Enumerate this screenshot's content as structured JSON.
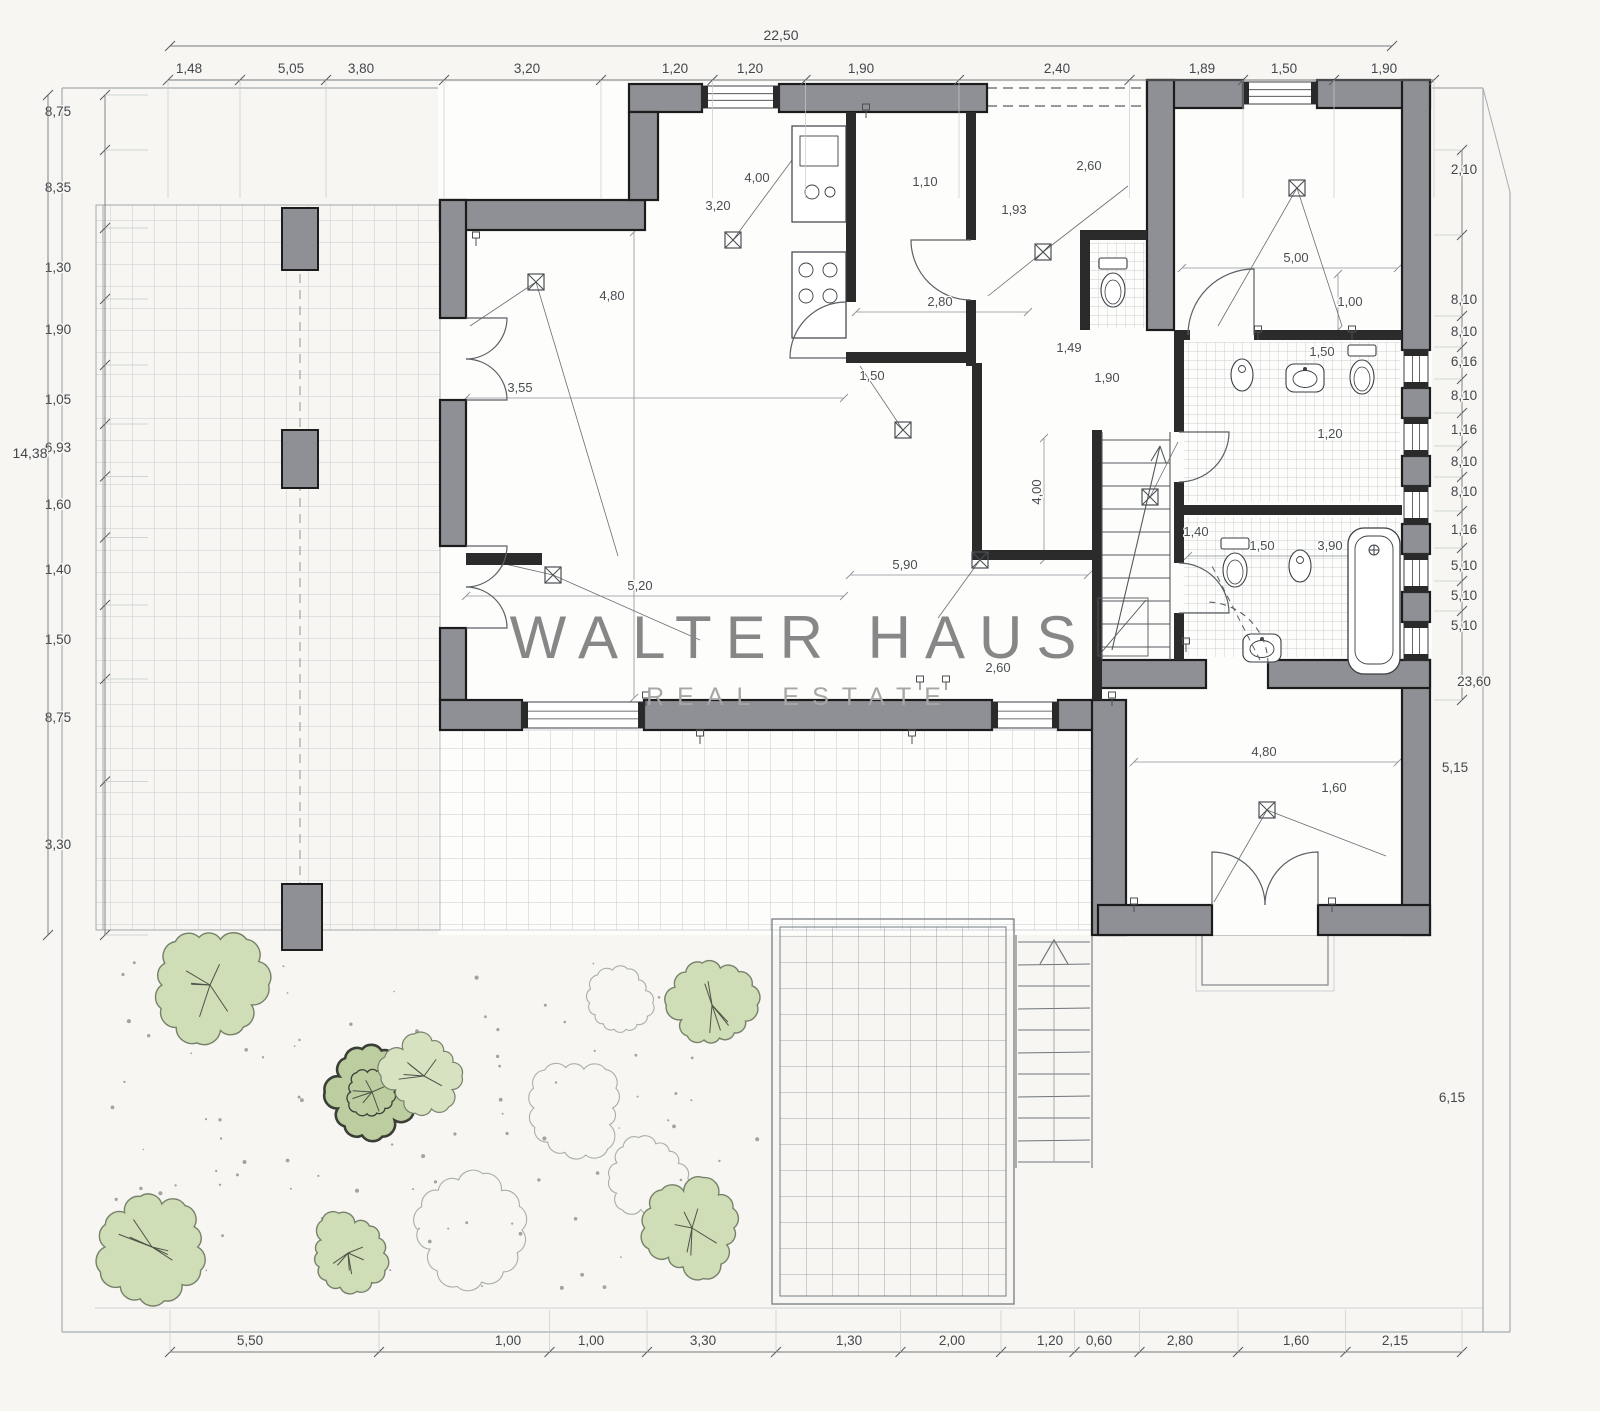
{
  "watermark": {
    "title": "WALTER HAUS",
    "subtitle": "REAL ESTATE"
  },
  "colors": {
    "paper": "#f7f6f3",
    "floor": "#fdfdfc",
    "wall_fill": "#8e9095",
    "wall_outline": "#1c1c1c",
    "partition": "#2b2b2b",
    "tile_line": "#c7cacc",
    "boundary_line": "#a7acb0",
    "dim_line": "#74797d",
    "dim_text": "#43474b",
    "watermark_title": "#878787",
    "watermark_subtitle": "#a6a6a6",
    "tree_fill": "#cfdeb6",
    "tree_outline": "#76816a",
    "tree_dark": "#3a3e36"
  },
  "symbols": {
    "ceiling_light": "crossed-square",
    "door": "quarter-arc",
    "window": "double-line",
    "stairs": "parallel-treads",
    "tree": "scalloped-blob"
  },
  "dimensions": {
    "top_total": {
      "t": "22,50",
      "x": 781
    },
    "top": [
      {
        "t": "1,48",
        "x": 189
      },
      {
        "t": "5,05",
        "x": 291
      },
      {
        "t": "3,80",
        "x": 361
      },
      {
        "t": "3,20",
        "x": 527
      },
      {
        "t": "1,20",
        "x": 675
      },
      {
        "t": "1,20",
        "x": 750
      },
      {
        "t": "1,90",
        "x": 861
      },
      {
        "t": "2,40",
        "x": 1057
      },
      {
        "t": "1,89",
        "x": 1202
      },
      {
        "t": "1,50",
        "x": 1284
      },
      {
        "t": "1,90",
        "x": 1384
      }
    ],
    "left_total": {
      "t": "14,38",
      "y": 458
    },
    "left": [
      {
        "t": "8,75",
        "y": 112
      },
      {
        "t": "8,35",
        "y": 188
      },
      {
        "t": "1,30",
        "y": 268
      },
      {
        "t": "1,90",
        "y": 330
      },
      {
        "t": "1,05",
        "y": 400
      },
      {
        "t": "6,93",
        "y": 448
      },
      {
        "t": "1,60",
        "y": 505
      },
      {
        "t": "1,40",
        "y": 570
      },
      {
        "t": "1,50",
        "y": 640
      },
      {
        "t": "8,75",
        "y": 718
      },
      {
        "t": "3,30",
        "y": 845
      }
    ],
    "right": [
      {
        "t": "2,10",
        "y": 170
      },
      {
        "t": "8,10",
        "y": 300
      },
      {
        "t": "8,10",
        "y": 332
      },
      {
        "t": "6,16",
        "y": 362
      },
      {
        "t": "8,10",
        "y": 396
      },
      {
        "t": "1,16",
        "y": 430
      },
      {
        "t": "8,10",
        "y": 462
      },
      {
        "t": "8,10",
        "y": 492
      },
      {
        "t": "1,16",
        "y": 530
      },
      {
        "t": "5,10",
        "y": 566
      },
      {
        "t": "5,10",
        "y": 596
      },
      {
        "t": "5,10",
        "y": 626
      }
    ],
    "right_outer": [
      {
        "t": "23,60",
        "x": 1474,
        "y": 686
      },
      {
        "t": "5,15",
        "x": 1455,
        "y": 772
      },
      {
        "t": "6,15",
        "x": 1452,
        "y": 1102
      }
    ],
    "bottom": [
      {
        "t": "5,50",
        "x": 250
      },
      {
        "t": "1,00",
        "x": 508
      },
      {
        "t": "1,00",
        "x": 591
      },
      {
        "t": "3,30",
        "x": 703
      },
      {
        "t": "1,30",
        "x": 849
      },
      {
        "t": "2,00",
        "x": 952
      },
      {
        "t": "1,20",
        "x": 1050
      },
      {
        "t": "0,60",
        "x": 1099
      },
      {
        "t": "2,80",
        "x": 1180
      },
      {
        "t": "1,60",
        "x": 1296
      },
      {
        "t": "2,15",
        "x": 1395
      }
    ]
  },
  "interior_labels": [
    {
      "t": "3,55",
      "x": 520,
      "y": 392
    },
    {
      "t": "4,80",
      "x": 612,
      "y": 300
    },
    {
      "t": "5,20",
      "x": 640,
      "y": 590
    },
    {
      "t": "5,90",
      "x": 905,
      "y": 569
    },
    {
      "t": "4,00",
      "x": 757,
      "y": 182
    },
    {
      "t": "3,20",
      "x": 718,
      "y": 210
    },
    {
      "t": "1,10",
      "x": 925,
      "y": 186
    },
    {
      "t": "1,93",
      "x": 1014,
      "y": 214
    },
    {
      "t": "2,60",
      "x": 1089,
      "y": 170
    },
    {
      "t": "2,80",
      "x": 940,
      "y": 306
    },
    {
      "t": "1,50",
      "x": 872,
      "y": 380
    },
    {
      "t": "1,49",
      "x": 1069,
      "y": 352
    },
    {
      "t": "1,90",
      "x": 1107,
      "y": 382
    },
    {
      "t": "5,00",
      "x": 1296,
      "y": 262
    },
    {
      "t": "1,00",
      "x": 1350,
      "y": 306
    },
    {
      "t": "4,00",
      "x": 1041,
      "y": 492,
      "r": 90
    },
    {
      "t": "1,40",
      "x": 1196,
      "y": 536
    },
    {
      "t": "1,50",
      "x": 1262,
      "y": 550
    },
    {
      "t": "3,90",
      "x": 1330,
      "y": 550
    },
    {
      "t": "4,80",
      "x": 1264,
      "y": 756
    },
    {
      "t": "1,60",
      "x": 1334,
      "y": 792
    },
    {
      "t": "2,60",
      "x": 998,
      "y": 672
    },
    {
      "t": "1,50",
      "x": 1322,
      "y": 356
    },
    {
      "t": "1,20",
      "x": 1330,
      "y": 438
    }
  ]
}
